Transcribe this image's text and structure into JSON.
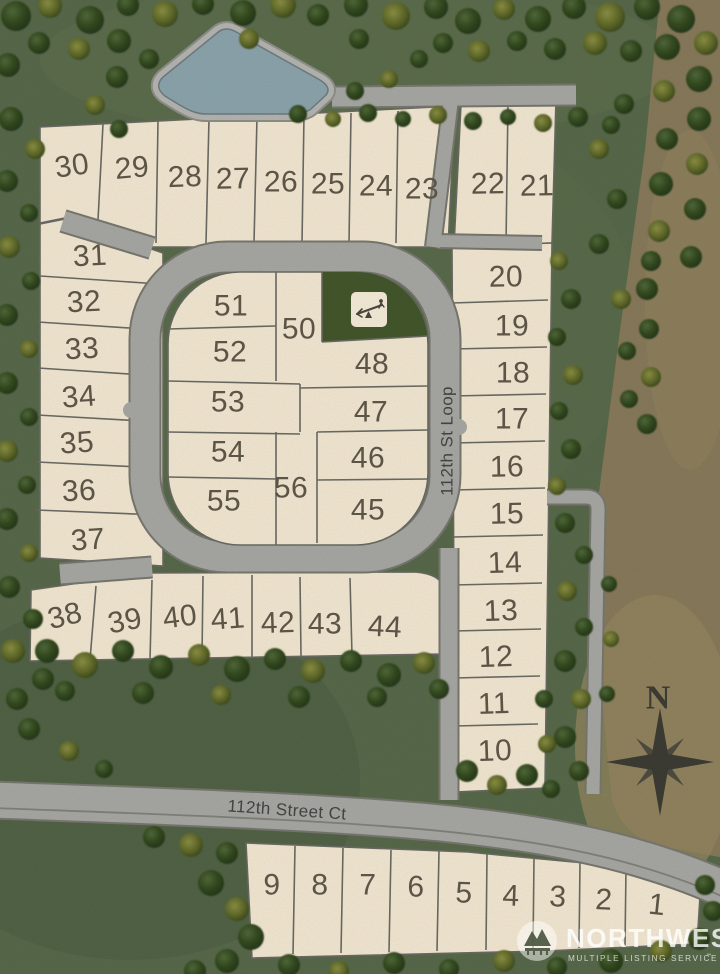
{
  "map": {
    "type": "residential plat site map",
    "lot_count_visible": 55
  },
  "lots": {
    "numbers": [
      "1",
      "2",
      "3",
      "4",
      "5",
      "6",
      "7",
      "8",
      "9",
      "10",
      "11",
      "12",
      "13",
      "14",
      "15",
      "16",
      "17",
      "18",
      "19",
      "20",
      "21",
      "22",
      "23",
      "24",
      "25",
      "26",
      "27",
      "28",
      "29",
      "30",
      "31",
      "32",
      "33",
      "34",
      "35",
      "36",
      "37",
      "38",
      "39",
      "40",
      "41",
      "42",
      "43",
      "44",
      "45",
      "46",
      "47",
      "48",
      "50",
      "51",
      "52",
      "53",
      "54",
      "55",
      "56"
    ]
  },
  "streets": {
    "loop": "112th St Loop",
    "court": "112th Street Ct"
  },
  "compass": {
    "north": "N"
  },
  "watermark": {
    "brand": "NORTHWEST",
    "tagline": "MULTIPLE LISTING SERVICE",
    "service_mark": "℠"
  },
  "icons": {
    "playground": "seesaw-icon",
    "compass": "compass-rose-icon",
    "logo_glyph": "mountain-bridge-icon"
  },
  "colors": {
    "grass": "#57684a",
    "grass_light": "#61714f",
    "grass_dark": "#4b5c3f",
    "dirt": "#87795a",
    "dirt_light": "#93865f",
    "lot_fill": "#f1e6d0",
    "lot_line": "#6a6a63",
    "road_fill": "#a6a6a2",
    "road_edge": "#77776f",
    "water": "#8ba3ab",
    "water_edge": "#6d7a7e",
    "park": "#42562b",
    "tree_dark": "#2e4521",
    "tree_olive": "#79823a",
    "number_ink": "#5c5446",
    "street_ink": "#424240",
    "compass_ink": "#3a3a32"
  }
}
